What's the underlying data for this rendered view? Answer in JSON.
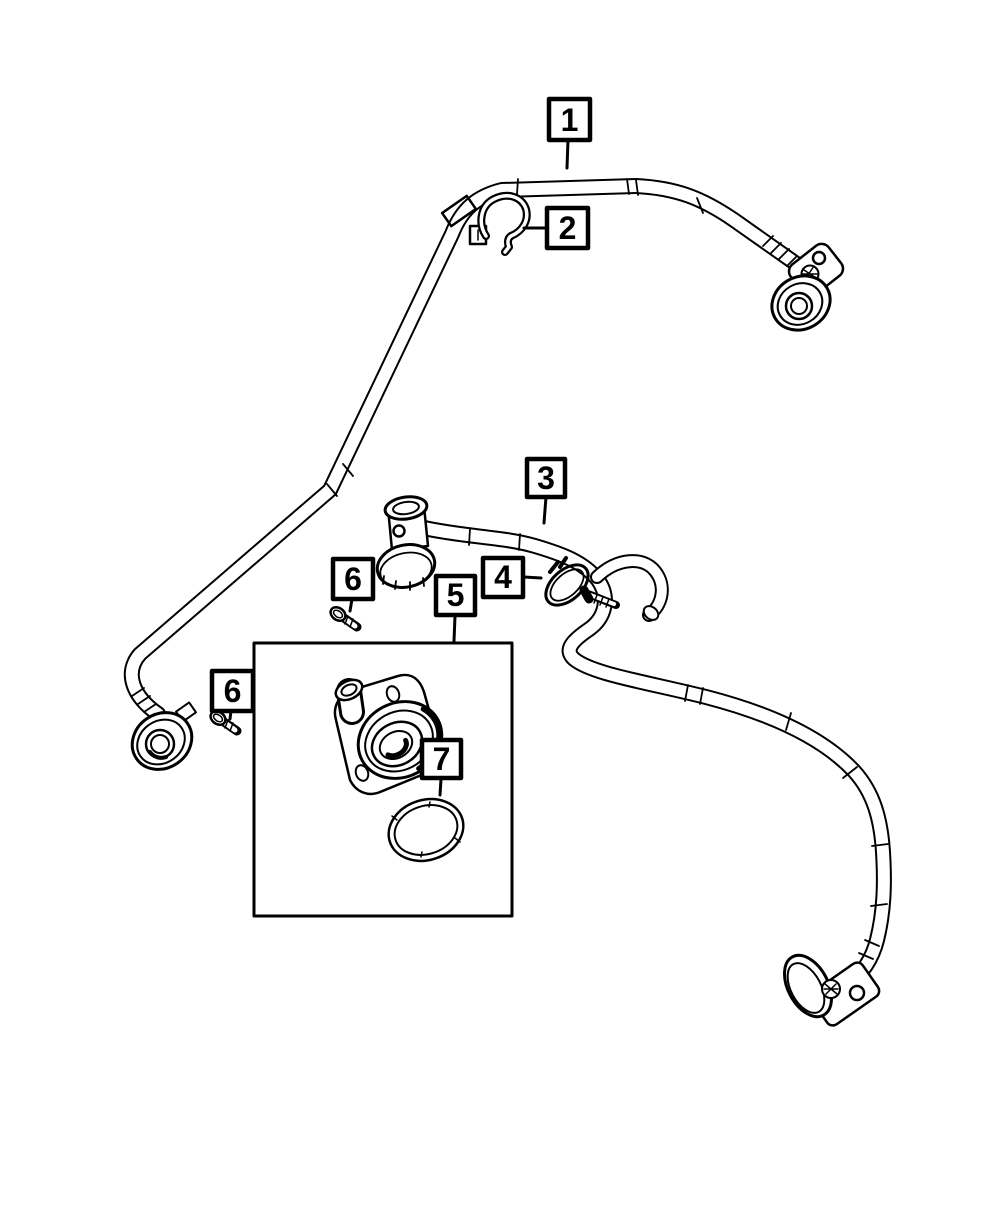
{
  "page": {
    "background": "#ffffff",
    "line_color": "#000000",
    "description": "exploded-parts-line-diagram"
  },
  "callouts": {
    "c1": {
      "label": "1"
    },
    "c2": {
      "label": "2"
    },
    "c3": {
      "label": "3"
    },
    "c4": {
      "label": "4"
    },
    "c5": {
      "label": "5"
    },
    "c6a": {
      "label": "6"
    },
    "c6b": {
      "label": "6"
    },
    "c7": {
      "label": "7"
    }
  }
}
